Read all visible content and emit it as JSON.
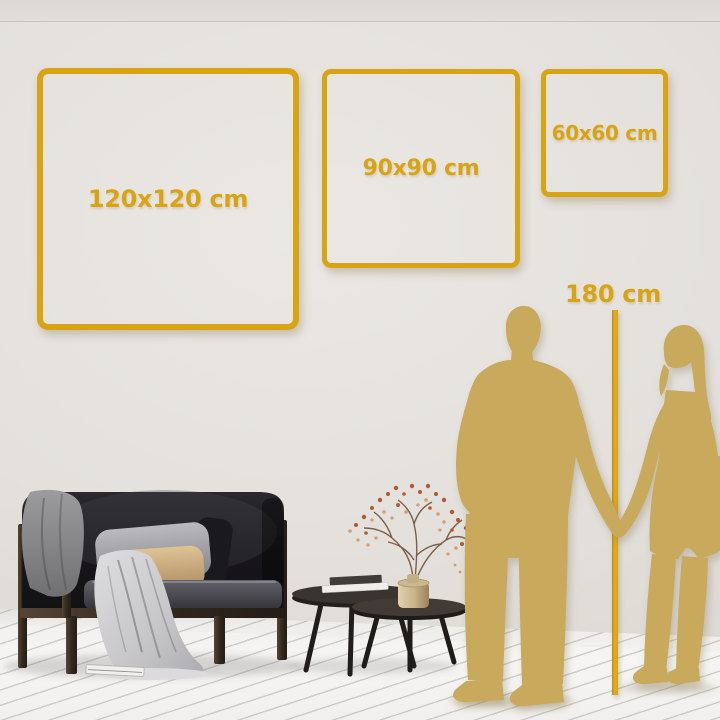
{
  "scene": {
    "type": "wall-art-size-guide",
    "frames": [
      {
        "name": "frame-120",
        "label": "120x120 cm"
      },
      {
        "name": "frame-90",
        "label": "90x90 cm"
      },
      {
        "name": "frame-60",
        "label": "60x60 cm"
      }
    ],
    "height_reference": {
      "label": "180 cm"
    },
    "palette": {
      "accent_gold": "#D9A413",
      "silhouette_gold": "#C9A95B",
      "wall": "#E3E0DC",
      "floor": "#F5F4F3",
      "sofa_dark": "#1C1B1F",
      "wood_brown": "#3E3328",
      "tan_pillow": "#C8A878",
      "blossom_rust": "#B2592F"
    }
  }
}
